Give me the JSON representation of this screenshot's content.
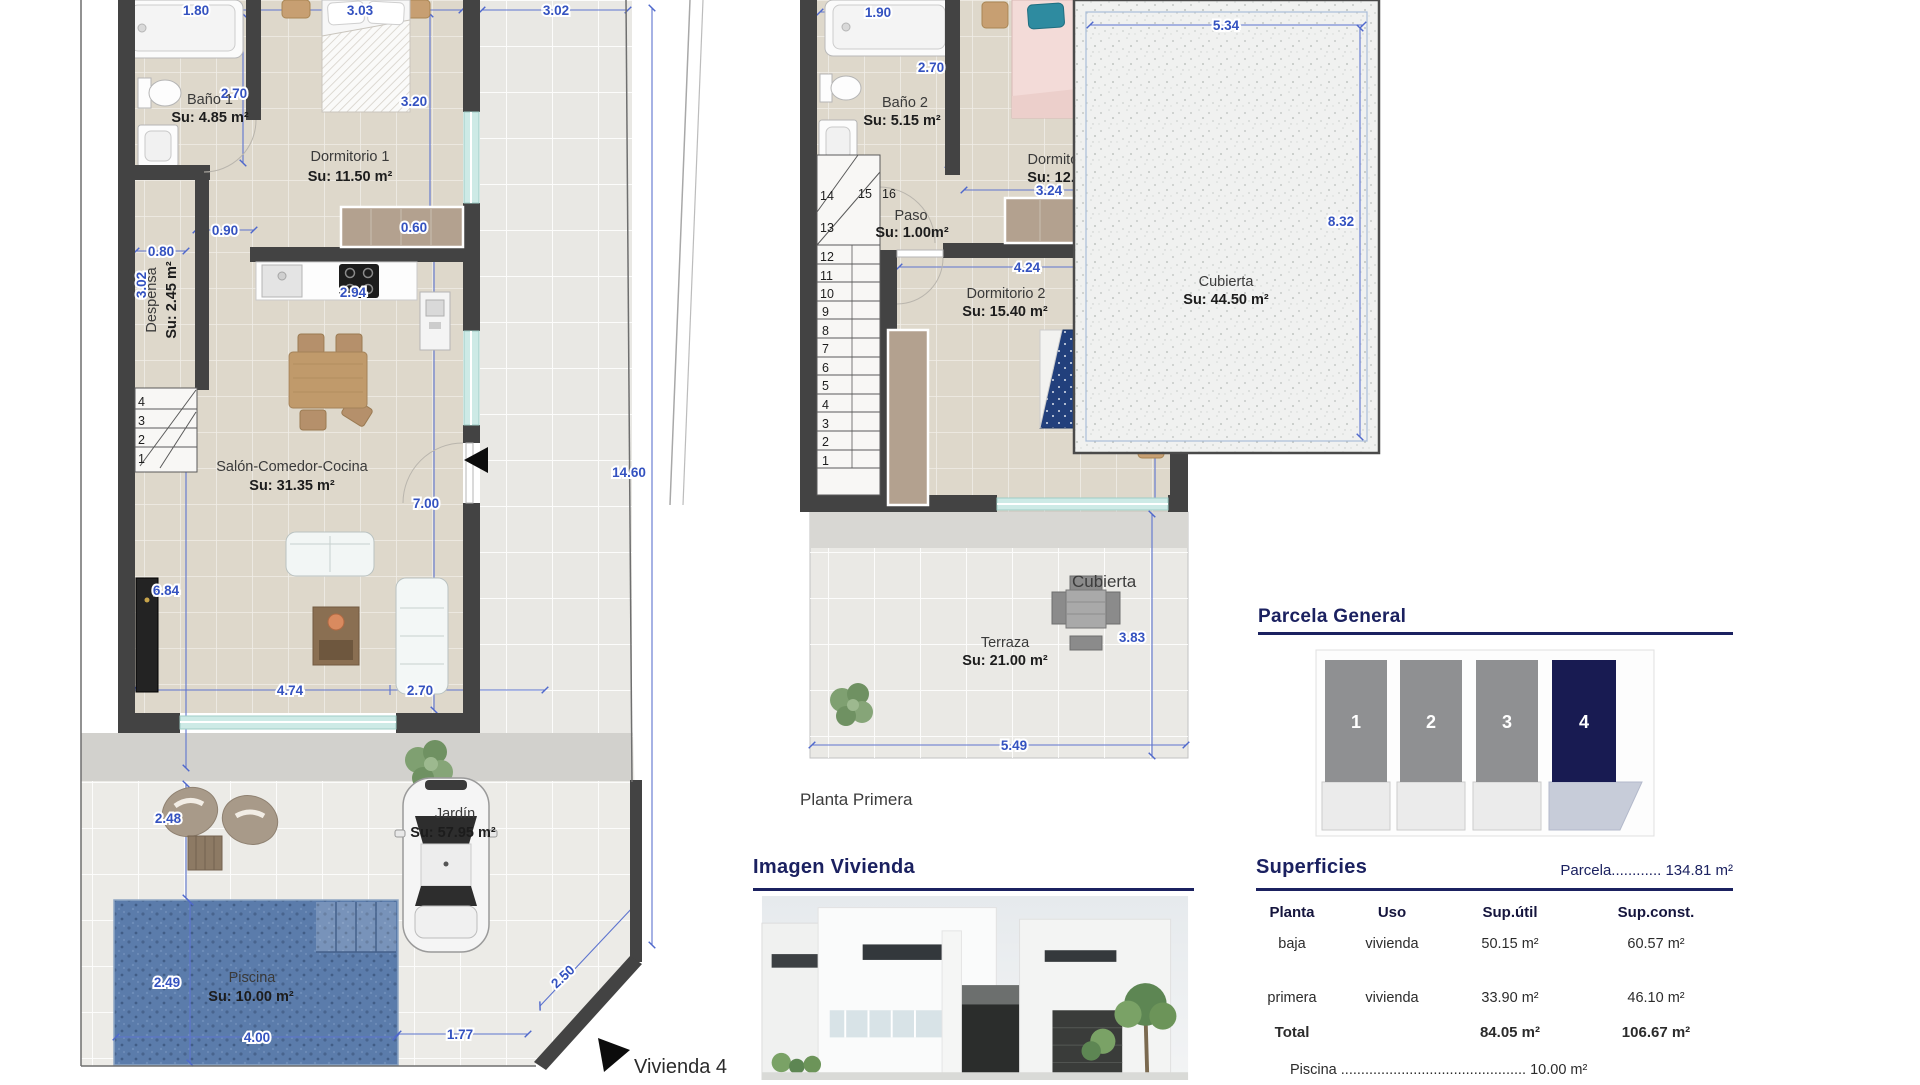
{
  "baja": {
    "rooms": {
      "bano1": {
        "name": "Baño 1",
        "area": "Su: 4.85 m²"
      },
      "dorm1": {
        "name": "Dormitorio 1",
        "area": "Su: 11.50 m²"
      },
      "despensa": {
        "name": "Despensa",
        "area": "Su: 2.45 m²"
      },
      "salon": {
        "name": "Salón-Comedor-Cocina",
        "area": "Su: 31.35 m²"
      },
      "jardin": {
        "name": "Jardín",
        "area": "Su: 57.95 m²"
      },
      "piscina": {
        "name": "Piscina",
        "area": "Su: 10.00 m²"
      }
    },
    "dims": {
      "top1": "1.80",
      "top2": "3.03",
      "patio": "3.02",
      "bath_h": "2.70",
      "dorm1_h": "3.20",
      "hall": "0.90",
      "desp_w": "0.80",
      "desp_h": "3.02",
      "ward": "0.60",
      "kitchen": "2.94",
      "parcel_h": "14.60",
      "salon_h": "7.00",
      "left_h": "6.84",
      "salon_w": "4.74",
      "salon_w2": "2.70",
      "patio2_h": "2.48",
      "pool_h": "2.49",
      "pool_w": "4.00",
      "pool_gap": "1.77",
      "chamfer": "2.50"
    },
    "stairs": [
      "4",
      "3",
      "2",
      "1"
    ],
    "unit_label": "Vivienda 4"
  },
  "primera": {
    "rooms": {
      "bano2": {
        "name": "Baño 2",
        "area": "Su: 5.15 m²"
      },
      "dorm3": {
        "name": "Dormitorio 3",
        "area": "Su: 12.35 m²"
      },
      "paso": {
        "name": "Paso",
        "area": "Su: 1.00m²"
      },
      "dorm2": {
        "name": "Dormitorio 2",
        "area": "Su: 15.40 m²"
      },
      "terraza": {
        "name": "Terraza",
        "area": "Su: 21.00 m²"
      }
    },
    "dims": {
      "bath_w": "1.90",
      "bath_h": "2.70",
      "dorm3_h": "3.20",
      "dorm3_w": "3.24",
      "ward": "0.60",
      "dorm2_w": "4.24",
      "dorm2_h": "3.32",
      "terr_h": "3.83",
      "terr_w": "5.49"
    },
    "stairs": [
      "14",
      "15",
      "16",
      "13",
      "12",
      "11",
      "10",
      "9",
      "8",
      "7",
      "6",
      "5",
      "4",
      "3",
      "2",
      "1"
    ],
    "label": "Planta Primera"
  },
  "cubierta": {
    "room": {
      "name": "Cubierta",
      "area": "Su: 44.50 m²"
    },
    "dims": {
      "w": "5.34",
      "h": "8.32"
    },
    "caption": "Cubierta"
  },
  "parcela": {
    "title": "Parcela General",
    "plots": [
      "1",
      "2",
      "3",
      "4"
    ]
  },
  "imagen": {
    "title": "Imagen Vivienda"
  },
  "superficies": {
    "title": "Superficies",
    "parcela_line": "Parcela............ 134.81 m²",
    "columns": [
      "Planta",
      "Uso",
      "Sup.útil",
      "Sup.const."
    ],
    "rows": [
      {
        "planta": "baja",
        "uso": "vivienda",
        "util": "50.15 m²",
        "const": "60.57 m²"
      },
      {
        "planta": "primera",
        "uso": "vivienda",
        "util": "33.90 m²",
        "const": "46.10 m²"
      }
    ],
    "total": {
      "planta": "Total",
      "util": "84.05 m²",
      "const": "106.67 m²"
    },
    "piscina_line": "Piscina .............................................. 10.00 m²"
  }
}
